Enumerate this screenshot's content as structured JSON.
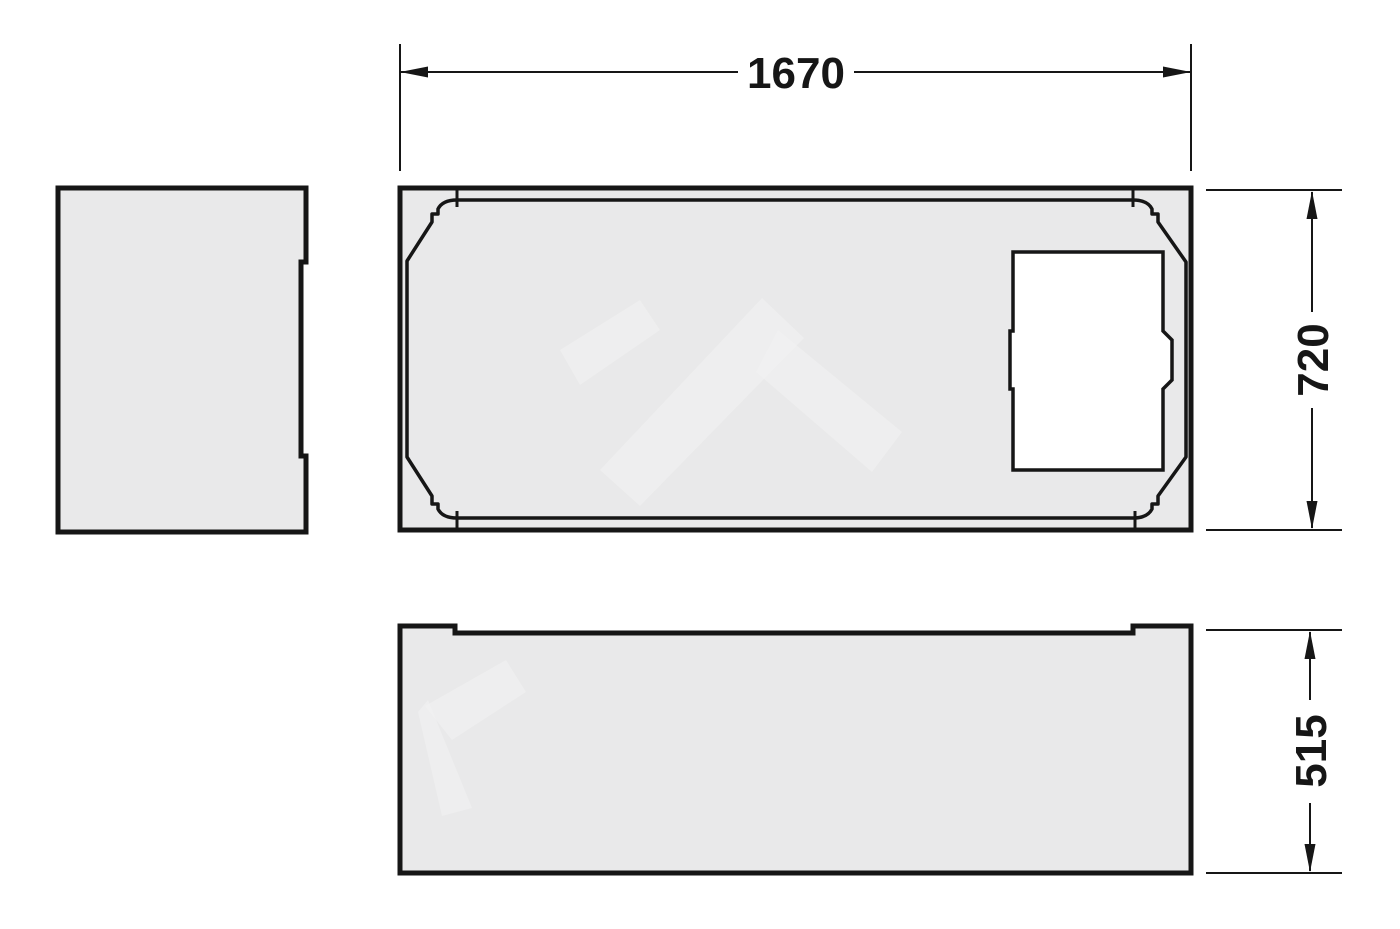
{
  "colors": {
    "background": "#ffffff",
    "panel-fill": "#e9e9ea",
    "cutout-fill": "#ffffff",
    "line": "#161616",
    "watermark": "#f2f2f3"
  },
  "drawing": {
    "kind": "bathtub-support-technical-drawing",
    "views": [
      {
        "id": "side-view",
        "description": "end panel (left)"
      },
      {
        "id": "plan-view",
        "description": "top view with tub contour and access opening"
      },
      {
        "id": "front-view",
        "description": "front panel (bottom)"
      }
    ],
    "dimensions": {
      "width": {
        "label": "1670",
        "orientation": "horizontal",
        "applies_to": "plan-view overall width"
      },
      "depth": {
        "label": "720",
        "orientation": "vertical",
        "applies_to": "plan-view overall depth"
      },
      "height": {
        "label": "515",
        "orientation": "vertical",
        "applies_to": "front-view overall height"
      }
    }
  }
}
